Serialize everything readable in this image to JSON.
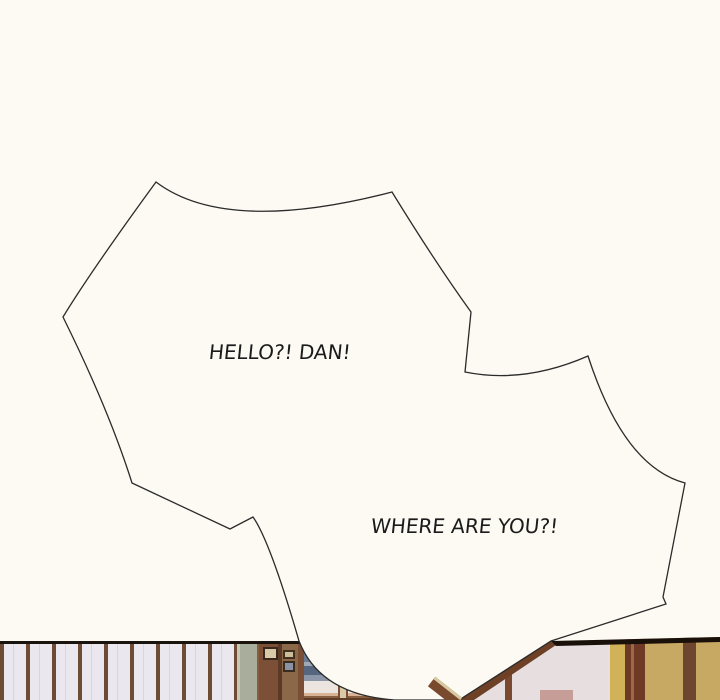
{
  "panel": {
    "background_color": "#fcfaf3",
    "bubble_fill": "#fcfaf3",
    "bubble_outline": "#2b2b2b",
    "text_color": "#1b1b1b"
  },
  "dialogue": [
    {
      "id": "bubble-1",
      "shape": "jagged-shout-bubble",
      "text": "HELLO?! DAN!"
    },
    {
      "id": "bubble-2",
      "shape": "jagged-shout-bubble",
      "text": "WHERE ARE YOU?!"
    }
  ],
  "artwork": {
    "description": "interior-room-strip",
    "palette": {
      "wall_panel": "#eae8ee",
      "wall_stripe_brown": "#6f4b36",
      "olive_column": "#a9ad9b",
      "wood_post": "#7b5036",
      "window_sky": "#6b7a92",
      "window_cloud_band": "#ece5df",
      "window_sunset": "#d8b294",
      "window_sill": "#5f3c28",
      "right_wall_cream": "#e7dee0",
      "right_wall_gold": "#d2b258",
      "right_wall_brown": "#6e4026",
      "top_edge_line": "#1a120c"
    }
  }
}
